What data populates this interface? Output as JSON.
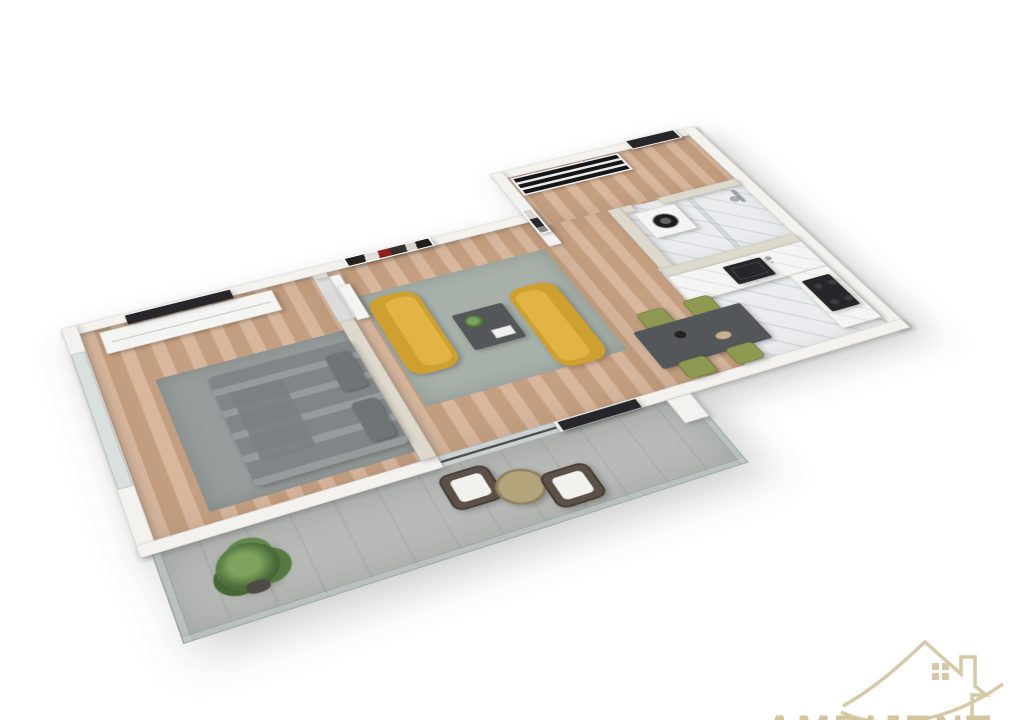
{
  "image": {
    "kind": "3d-apartment-floor-plan-render",
    "view": "isometric-top-down",
    "background": "#ffffff"
  },
  "watermark": {
    "text": "AMBIJENT",
    "logo": "house-outline-with-arrow-and-window",
    "color": "#d3c39e"
  },
  "palette": {
    "background": "#ffffff",
    "wall-outer": "#f3f2ef",
    "wall-inner": "#ded9cd",
    "floor-wood": "#cfa787",
    "floor-marble": "#eaecee",
    "floor-concrete": "#b7bab7",
    "rug-living": "#a7b0a9",
    "rug-bedroom": "#979d9c",
    "sofa-mustard": "#cf9f30",
    "sofa-light": "#e2b446",
    "chair-olive": "#8e9a52",
    "table-dark": "#54575a",
    "door-dark": "#27272b",
    "bed-gray": "#8b9092",
    "pillow-gray": "#6f7476",
    "glass": "#c6d2d1",
    "appliance-white": "#f4f4f2",
    "art-red": "#8d1f1f",
    "wm-tan": "#d3c39e"
  },
  "rooms": [
    {
      "name": "bedroom",
      "furniture": [
        "double-bed-gray-bedding",
        "two-pillows",
        "gray-area-rug",
        "white-tv-sideboard",
        "wall-mounted-tv",
        "abstract-red-black-wall-art",
        "floor-to-ceiling-glass-window",
        "open-interior-door"
      ]
    },
    {
      "name": "living-room",
      "furniture": [
        "mustard-loveseat",
        "mustard-loveseat",
        "dark-coffee-table-with-plant-and-books",
        "gray-green-area-rug",
        "wall-mounted-tv",
        "white-radiator",
        "sliding-glass-balcony-door"
      ]
    },
    {
      "name": "entry-hall",
      "furniture": [
        "dark-entrance-door",
        "open-shelf-wardrobe",
        "black-white-framed-art"
      ]
    },
    {
      "name": "bathroom",
      "furniture": [
        "washing-machine",
        "walk-in-shower",
        "glass-partition",
        "chrome-shower-column",
        "marble-floor"
      ]
    },
    {
      "name": "kitchen",
      "furniture": [
        "l-shaped-counter-marble-top",
        "black-undermount-sink",
        "faucet",
        "black-cooktop",
        "gray-cabinet-fronts"
      ]
    },
    {
      "name": "dining-area",
      "furniture": [
        "dark-gray-dining-table",
        "olive-chair",
        "olive-chair",
        "olive-chair",
        "olive-chair",
        "vase-centerpiece",
        "bowl-centerpiece"
      ]
    },
    {
      "name": "balcony",
      "furniture": [
        "potted-palm-plant",
        "rattan-chair-white-cushion",
        "rattan-chair-white-cushion",
        "round-rattan-side-table",
        "glass-railing",
        "concrete-floor"
      ]
    }
  ]
}
